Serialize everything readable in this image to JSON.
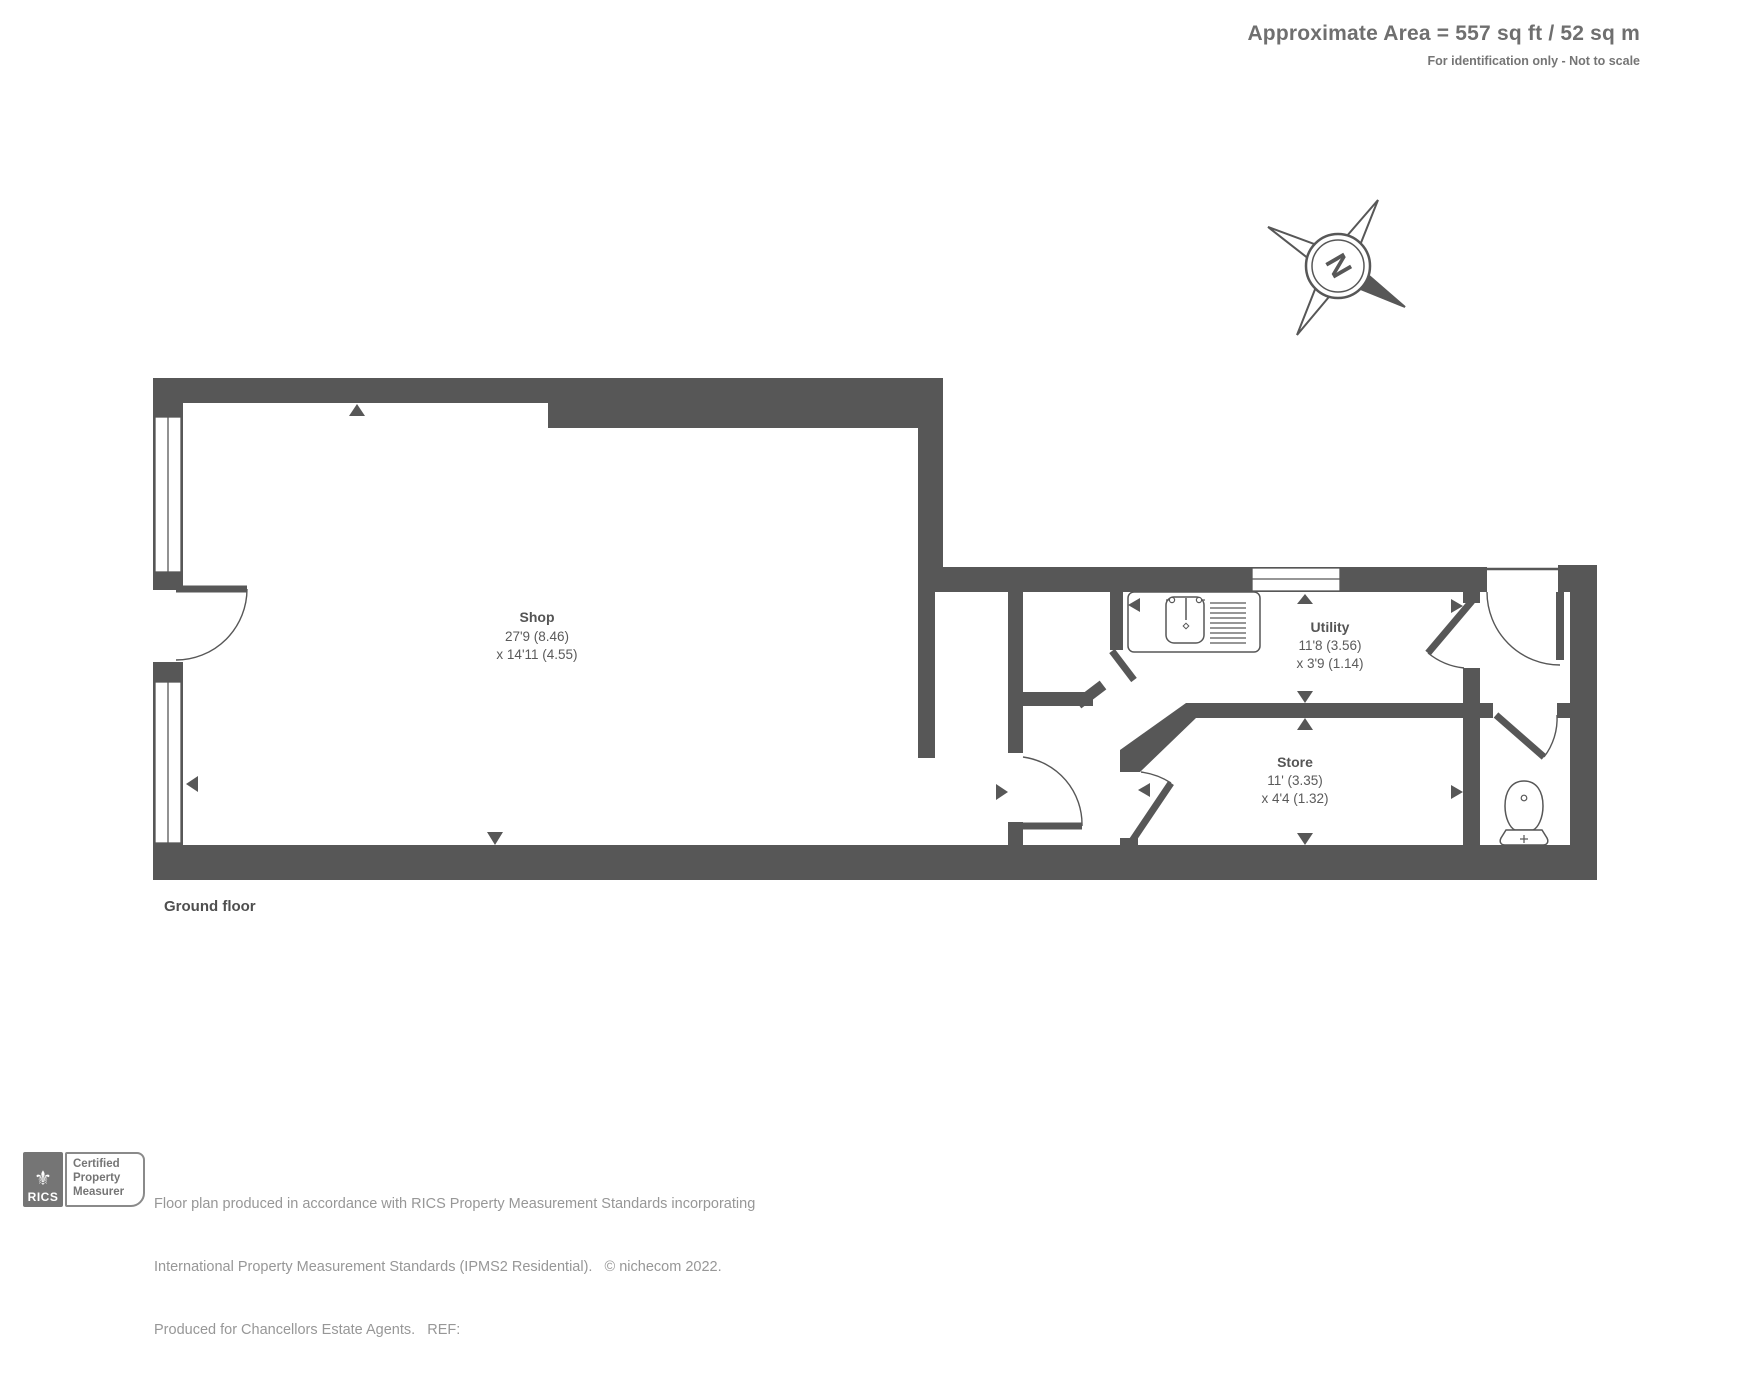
{
  "header": {
    "title": "Approximate Area = 557 sq ft / 52 sq m",
    "subtitle": "For identification only - Not to scale"
  },
  "plan": {
    "floor_label": "Ground floor",
    "compass_letter": "N",
    "rooms": [
      {
        "name": "Shop",
        "dim1": "27'9 (8.46)",
        "dim2": "x 14'11 (4.55)"
      },
      {
        "name": "Utility",
        "dim1": "11'8 (3.56)",
        "dim2": "x 3'9 (1.14)"
      },
      {
        "name": "Store",
        "dim1": "11' (3.35)",
        "dim2": "x 4'4 (1.32)"
      }
    ]
  },
  "footer": {
    "rics_label": "RICS",
    "badge_lines": [
      "Certified",
      "Property",
      "Measurer"
    ],
    "disclaimer_line1": "Floor plan produced in accordance with RICS Property Measurement Standards incorporating",
    "disclaimer_line2": "International Property Measurement Standards (IPMS2 Residential).   © nichecom 2022.",
    "disclaimer_line3": "Produced for Chancellors Estate Agents.   REF:"
  },
  "colors": {
    "wall": "#575757",
    "label": "#555555",
    "faint": "#979797"
  }
}
